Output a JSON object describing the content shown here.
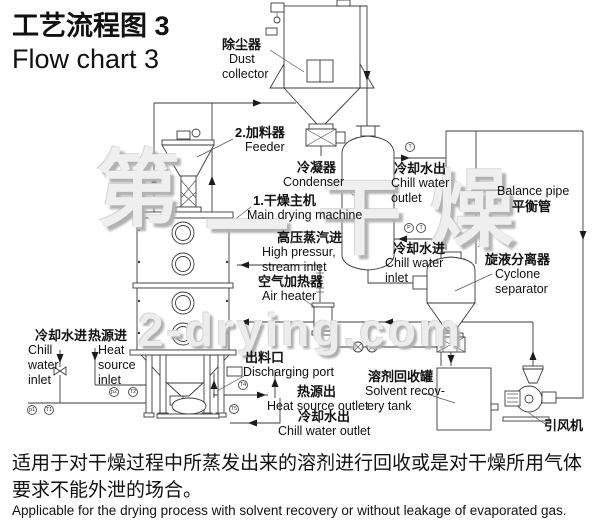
{
  "header": {
    "title_zh": "工艺流程图 3",
    "title_en": "Flow chart 3"
  },
  "labels": {
    "dust_collector": {
      "zh": "除尘器",
      "en1": "Dust",
      "en2": "collector"
    },
    "feeder": {
      "zh": "2.加料器",
      "en": "Feeder"
    },
    "condenser": {
      "zh": "冷凝器",
      "en": "Condenser"
    },
    "main_machine": {
      "zh": "1.干燥主机",
      "en": "Main drying machine"
    },
    "steam_inlet": {
      "zh": "高压蒸汽进",
      "en1": "High pressur,",
      "en2": "stream inlet"
    },
    "air_heater": {
      "zh": "空气加热器",
      "en": "Air heater"
    },
    "chill_water_outlet_top": {
      "zh": "冷却水出",
      "en1": "Chill water",
      "en2": "outlet"
    },
    "balance_pipe": {
      "en": "Balance pipe",
      "zh": "平衡管"
    },
    "chill_water_inlet_mid": {
      "zh": "冷却水进",
      "en1": "Chill water",
      "en2": "inlet"
    },
    "cyclone": {
      "zh": "旋液分离器",
      "en1": "Cyclone",
      "en2": "separator"
    },
    "chill_water_inlet_left": {
      "zh": "冷却水进",
      "en1": "Chill",
      "en2": "water",
      "en3": "inlet"
    },
    "heat_source_inlet": {
      "zh": "热源进",
      "en1": "Heat",
      "en2": "source",
      "en3": "inlet"
    },
    "discharging_port": {
      "zh": "出料口",
      "en": "Discharging port"
    },
    "heat_source_outlet": {
      "zh": "热源出",
      "en": "Heat source outlet"
    },
    "chill_water_outlet_bottom": {
      "zh": "冷却水出",
      "en": "Chill water outlet"
    },
    "solvent_tank": {
      "zh": "溶剂回收罐",
      "en1": "Solvent recov-",
      "en2": "ery tank"
    },
    "induced_draft_fan": {
      "zh": "引风机"
    }
  },
  "instruments": [
    {
      "x": 410,
      "y": 147,
      "label": "T"
    },
    {
      "x": 409,
      "y": 228,
      "label": "P"
    },
    {
      "x": 421,
      "y": 228,
      "label": "T"
    },
    {
      "x": 32,
      "y": 410,
      "label": "p1"
    },
    {
      "x": 49,
      "y": 410,
      "label": "T1"
    },
    {
      "x": 114,
      "y": 392,
      "label": "p2"
    },
    {
      "x": 133,
      "y": 392,
      "label": "T2"
    },
    {
      "x": 243,
      "y": 385,
      "label": "T4"
    },
    {
      "x": 234,
      "y": 409,
      "label": "T5"
    }
  ],
  "watermark": {
    "site": "2-drying.com",
    "chars": [
      {
        "ch": "第",
        "x": 96,
        "y": 148,
        "size": 84
      },
      {
        "ch": "一",
        "x": 205,
        "y": 186,
        "size": 84
      },
      {
        "ch": "干",
        "x": 318,
        "y": 176,
        "size": 84
      },
      {
        "ch": "燥",
        "x": 430,
        "y": 168,
        "size": 84
      }
    ]
  },
  "footer": {
    "zh1": "适用于对干燥过程中所蒸发出来的溶剂进行回收或是对干燥所用气体",
    "zh2": "要求不能外泄的场合。",
    "en": "Applicable for the drying process with solvent recovery or without leakage of evaporated gas."
  }
}
